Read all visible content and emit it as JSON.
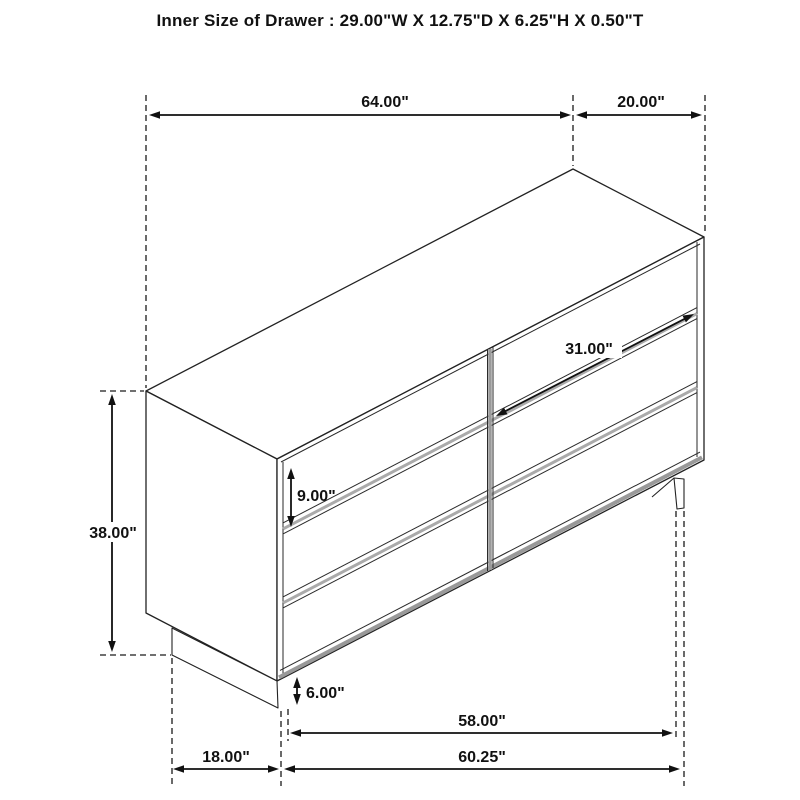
{
  "title": "Inner Size of Drawer : 29.00\"W X 12.75\"D X 6.25\"H X 0.50\"T",
  "drawing_type": "dresser-dimension-diagram",
  "dimensions": {
    "overall_width_top": "64.00\"",
    "overall_depth_top": "20.00\"",
    "overall_height": "38.00\"",
    "drawer_front_height": "9.00\"",
    "drawer_front_width": "31.00\"",
    "leg_height": "6.00\"",
    "inner_leg_span": "58.00\"",
    "overall_floor_width": "60.25\"",
    "base_depth": "18.00\""
  },
  "colors": {
    "line": "#1a1a1a",
    "dimension_line": "#111111",
    "shade_gray": "#a0a0a0",
    "light_gray": "#bdbdbd",
    "background": "#ffffff"
  },
  "structure": {
    "drawer_rows": 3,
    "drawer_columns": 2,
    "total_drawers": 6
  }
}
